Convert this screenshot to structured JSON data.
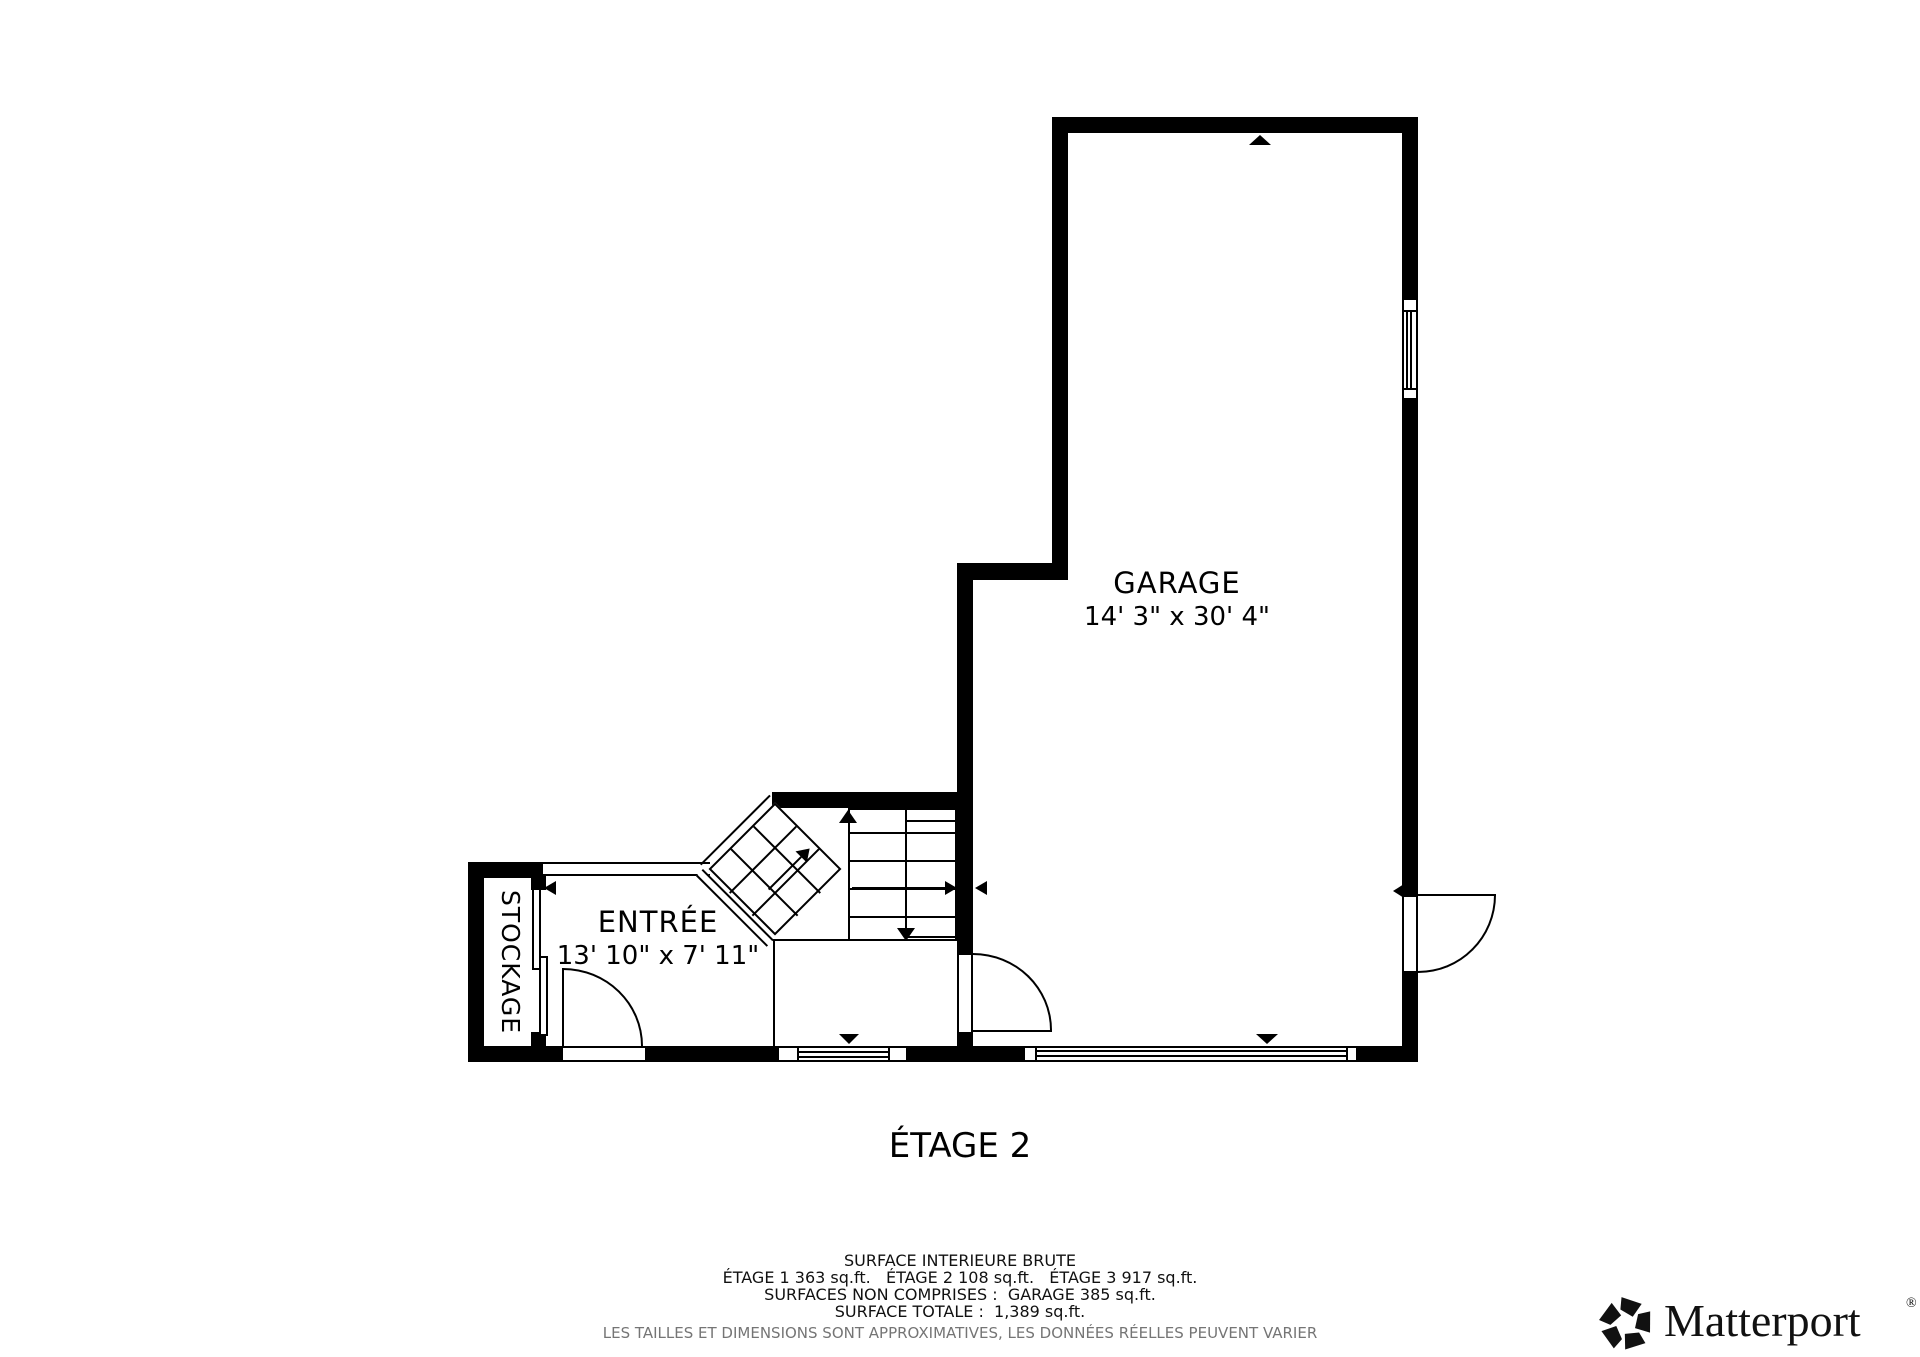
{
  "page": {
    "background": "#ffffff",
    "ink": "#000000",
    "muted": "#757575"
  },
  "rooms": {
    "garage": {
      "name": "GARAGE",
      "dimensions": "14' 3\" x 30' 4\""
    },
    "entree": {
      "name": "ENTRÉE",
      "dimensions": "13' 10\" x 7' 11\""
    },
    "stockage": {
      "name": "STOCKAGE"
    }
  },
  "floor_title": "ÉTAGE 2",
  "footer": {
    "line1": "SURFACE INTERIEURE BRUTE",
    "line2": "ÉTAGE 1 363 sq.ft.   ÉTAGE 2 108 sq.ft.   ÉTAGE 3 917 sq.ft.",
    "line3": "SURFACES NON COMPRISES :  GARAGE 385 sq.ft.",
    "line4": "SURFACE TOTALE :  1,389 sq.ft.",
    "disclaimer": "LES TAILLES ET DIMENSIONS SONT APPROXIMATIVES, LES DONNÉES RÉELLES PEUVENT VARIER"
  },
  "brand": {
    "name": "Matterport",
    "registered": "®"
  }
}
